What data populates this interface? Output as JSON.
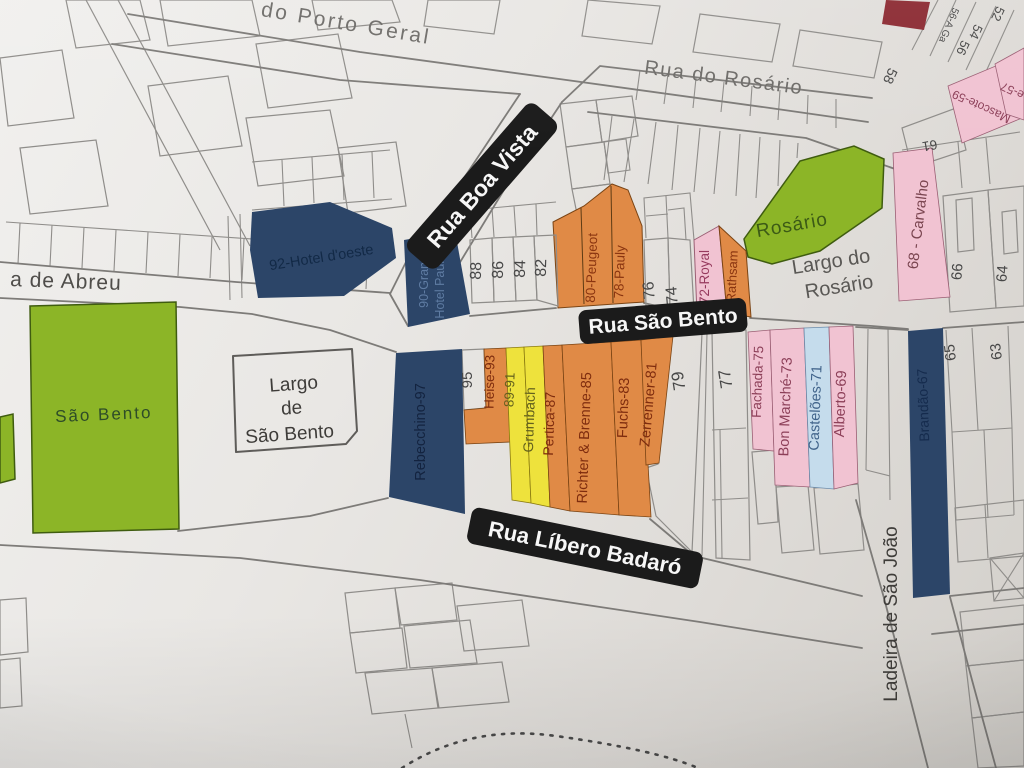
{
  "map": {
    "colors": {
      "green": "#8cb527",
      "navy": "#2c4568",
      "orange": "#e08a46",
      "yellow": "#eee23c",
      "pink": "#f1c3d2",
      "light_blue": "#c5dcec",
      "maroon": "#8c2b33",
      "pill_bg": "#1b1b1b",
      "pill_text": "#f7f7f7"
    },
    "street_labels": {
      "porto_geral": "do Porto Geral",
      "rua_do_rosario": "Rua do Rosário",
      "rua_boa_vista": "Rua Boa Vista",
      "rua_sao_bento": "Rua São Bento",
      "de_abreu": "a de Abreu",
      "rua_libero_badaro": "Rua Líbero Badaró",
      "ladeira_sao_joao": "Ladeira de São João",
      "largo_do_rosario_line1": "Largo do",
      "largo_do_rosario_line2": "Rosário",
      "largo_sao_bento_line1": "Largo",
      "largo_sao_bento_line2": "de",
      "largo_sao_bento_line3": "São Bento"
    },
    "buildings": {
      "landmarks": {
        "sao_bento": "São Bento",
        "rosario": "Rosário",
        "hotel_oeste": "92-Hotel d'oeste",
        "grande_hotel_line1": "90-Grande",
        "grande_hotel_line2": "Hotel Paulista"
      },
      "north_block": {
        "n88": "88",
        "n86": "86",
        "n84": "84",
        "n82": "82",
        "peugeot": "80-Peugeot",
        "pauly": "78-Pauly",
        "n76": "76",
        "n74": "74",
        "royal": "72-Royal",
        "rathsam": "70-Rathsam"
      },
      "south_block": {
        "rebecchino": "Rebecchino-97",
        "n95": "95",
        "heise": "Heise-93",
        "n89_91": "89-91",
        "grumbach": "Grumbach",
        "pertica": "Pertica-87",
        "richter": "Richter & Brenne-85",
        "fuchs": "Fuchs-83",
        "zerrenner": "Zerrenner-81",
        "n79": "79",
        "n77": "77",
        "fachada": "Fachada-75",
        "bon_marche": "Bon Marché-73",
        "casteloes": "Castelões-71",
        "alberto": "Alberto-69",
        "brandao": "Brandão-67",
        "n65": "65",
        "n63": "63"
      },
      "east_block": {
        "carvalho": "68 - Carvalho",
        "n66": "66",
        "n64": "64"
      },
      "northeast_block": {
        "n52": "52",
        "n54": "54",
        "n56a": "56-A Ga",
        "n56": "56",
        "n58": "58",
        "n61": "61",
        "mascote": "Mascote-59",
        "e57": "e-57"
      }
    }
  }
}
